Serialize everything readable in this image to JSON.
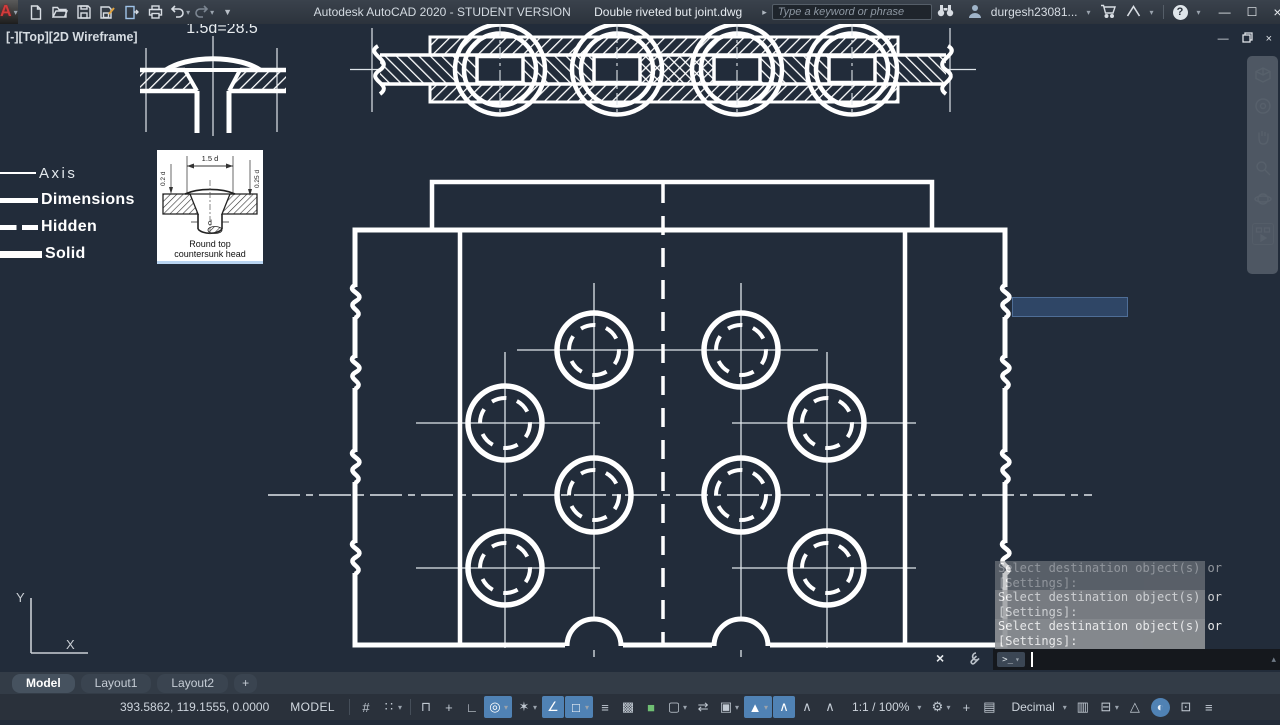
{
  "colors": {
    "canvas_bg": "#222c3a",
    "accent_blue": "#5082b4",
    "command_history_bg": "#8f9296",
    "selection_green": "#6fbf73"
  },
  "titlebar": {
    "app_title": "Autodesk AutoCAD 2020 - STUDENT VERSION",
    "doc_title": "Double riveted but joint.dwg",
    "search_placeholder": "Type a keyword or phrase",
    "username": "durgesh23081...",
    "qat_icons": [
      "new-file-icon",
      "open-file-icon",
      "save-icon",
      "save-as-icon",
      "plot-icon",
      "print-icon",
      "undo-icon",
      "redo-icon",
      "qat-customize-icon"
    ],
    "account_icons": [
      "search-go-icon",
      "binoculars-icon",
      "user-avatar-icon",
      "cart-icon",
      "autodesk-app-icon",
      "help-icon"
    ],
    "window_controls": [
      "minimize",
      "maximize",
      "close"
    ]
  },
  "viewport_label": "[-][Top][2D Wireframe]",
  "drawing": {
    "dim_note": "1.5d=28.5",
    "ucs_y": "Y",
    "ucs_x": "X"
  },
  "legend": {
    "items": [
      {
        "label": "Axis",
        "style": "thin"
      },
      {
        "label": "Dimensions",
        "style": "thick"
      },
      {
        "label": "Hidden",
        "style": "dashed"
      },
      {
        "label": "Solid",
        "style": "solid"
      }
    ]
  },
  "inset": {
    "dim_top": "1.5 d",
    "dim_left": "0.2 d",
    "dim_right": "0.25 d",
    "dim_dia": "d",
    "caption_line1": "Round top",
    "caption_line2": "countersunk head"
  },
  "nav_icons": [
    "viewcube-icon",
    "navigation-wheel-icon",
    "pan-hand-icon",
    "zoom-icon",
    "orbit-icon",
    "showmotion-icon"
  ],
  "command": {
    "history": [
      {
        "text": "Select destination object(s) or",
        "opacity": 0.5
      },
      {
        "text": "[Settings]:",
        "opacity": 0.5
      },
      {
        "text": "Select destination object(s) or",
        "opacity": 0.78
      },
      {
        "text": "[Settings]:",
        "opacity": 0.78
      },
      {
        "text": "Select destination object(s) or",
        "opacity": 0.9
      },
      {
        "text": "[Settings]:",
        "opacity": 0.9
      }
    ],
    "prompt_glyph": ">_",
    "input_value": ""
  },
  "tabs": [
    {
      "label": "Model",
      "active": true
    },
    {
      "label": "Layout1",
      "active": false
    },
    {
      "label": "Layout2",
      "active": false
    },
    {
      "label": "+",
      "active": false,
      "add": true
    }
  ],
  "statusbar": {
    "coordinates": "393.5862, 119.1555, 0.0000",
    "model_label": "MODEL",
    "items": [
      {
        "name": "grid-icon",
        "glyph": "#"
      },
      {
        "name": "snap-mode-icon",
        "glyph": "∷",
        "dropdown": true
      },
      {
        "separator": true
      },
      {
        "name": "infer-constraints-icon",
        "glyph": "⊓"
      },
      {
        "name": "dynamic-input-icon",
        "glyph": "+"
      },
      {
        "name": "ortho-mode-icon",
        "glyph": "∟"
      },
      {
        "name": "polar-tracking-icon",
        "glyph": "◎",
        "highlighted": true,
        "dropdown": true
      },
      {
        "name": "isodraft-icon",
        "glyph": "✶",
        "dropdown": true
      },
      {
        "name": "osnap-tracking-icon",
        "glyph": "∠",
        "highlighted": true
      },
      {
        "name": "object-snap-icon",
        "glyph": "□",
        "highlighted": true,
        "dropdown": true
      },
      {
        "name": "lineweight-icon",
        "glyph": "≡"
      },
      {
        "name": "transparency-icon",
        "glyph": "▩"
      },
      {
        "name": "selection-cycling-icon",
        "glyph": "■",
        "green": true
      },
      {
        "name": "3d-object-snap-icon",
        "glyph": "▢",
        "dropdown": true
      },
      {
        "name": "ucs-toggle-icon",
        "glyph": "⇄"
      },
      {
        "name": "annotation-scale-sync-icon",
        "glyph": "▣",
        "dropdown": true
      },
      {
        "name": "annotation-visibility-icon",
        "glyph": "▲",
        "highlighted": true,
        "dropdown": true
      },
      {
        "name": "annotation-autoscale-icon",
        "glyph": "∧",
        "highlighted": true
      },
      {
        "name": "annotation-add-scale-icon",
        "glyph": "∧"
      },
      {
        "name": "annotation-del-scale-icon",
        "glyph": "∧"
      },
      {
        "name": "annotation-scale-value",
        "text": "1:1 / 100%",
        "dropdown": true
      },
      {
        "name": "workspace-icon",
        "glyph": "⚙",
        "dropdown": true
      },
      {
        "name": "annotation-monitor-icon",
        "glyph": "+"
      },
      {
        "name": "units-icon",
        "glyph": "▤"
      },
      {
        "name": "units-value",
        "text": "Decimal",
        "dropdown": true
      },
      {
        "name": "quick-properties-icon",
        "glyph": "▥"
      },
      {
        "name": "lock-ui-icon",
        "glyph": "⊟",
        "dropdown": true
      },
      {
        "name": "isolate-objects-icon",
        "glyph": "△"
      },
      {
        "name": "graphics-performance-icon",
        "glyph": "◐",
        "circle": true
      },
      {
        "name": "clean-screen-icon",
        "glyph": "⊡"
      },
      {
        "name": "customize-icon",
        "glyph": "≡"
      }
    ]
  }
}
